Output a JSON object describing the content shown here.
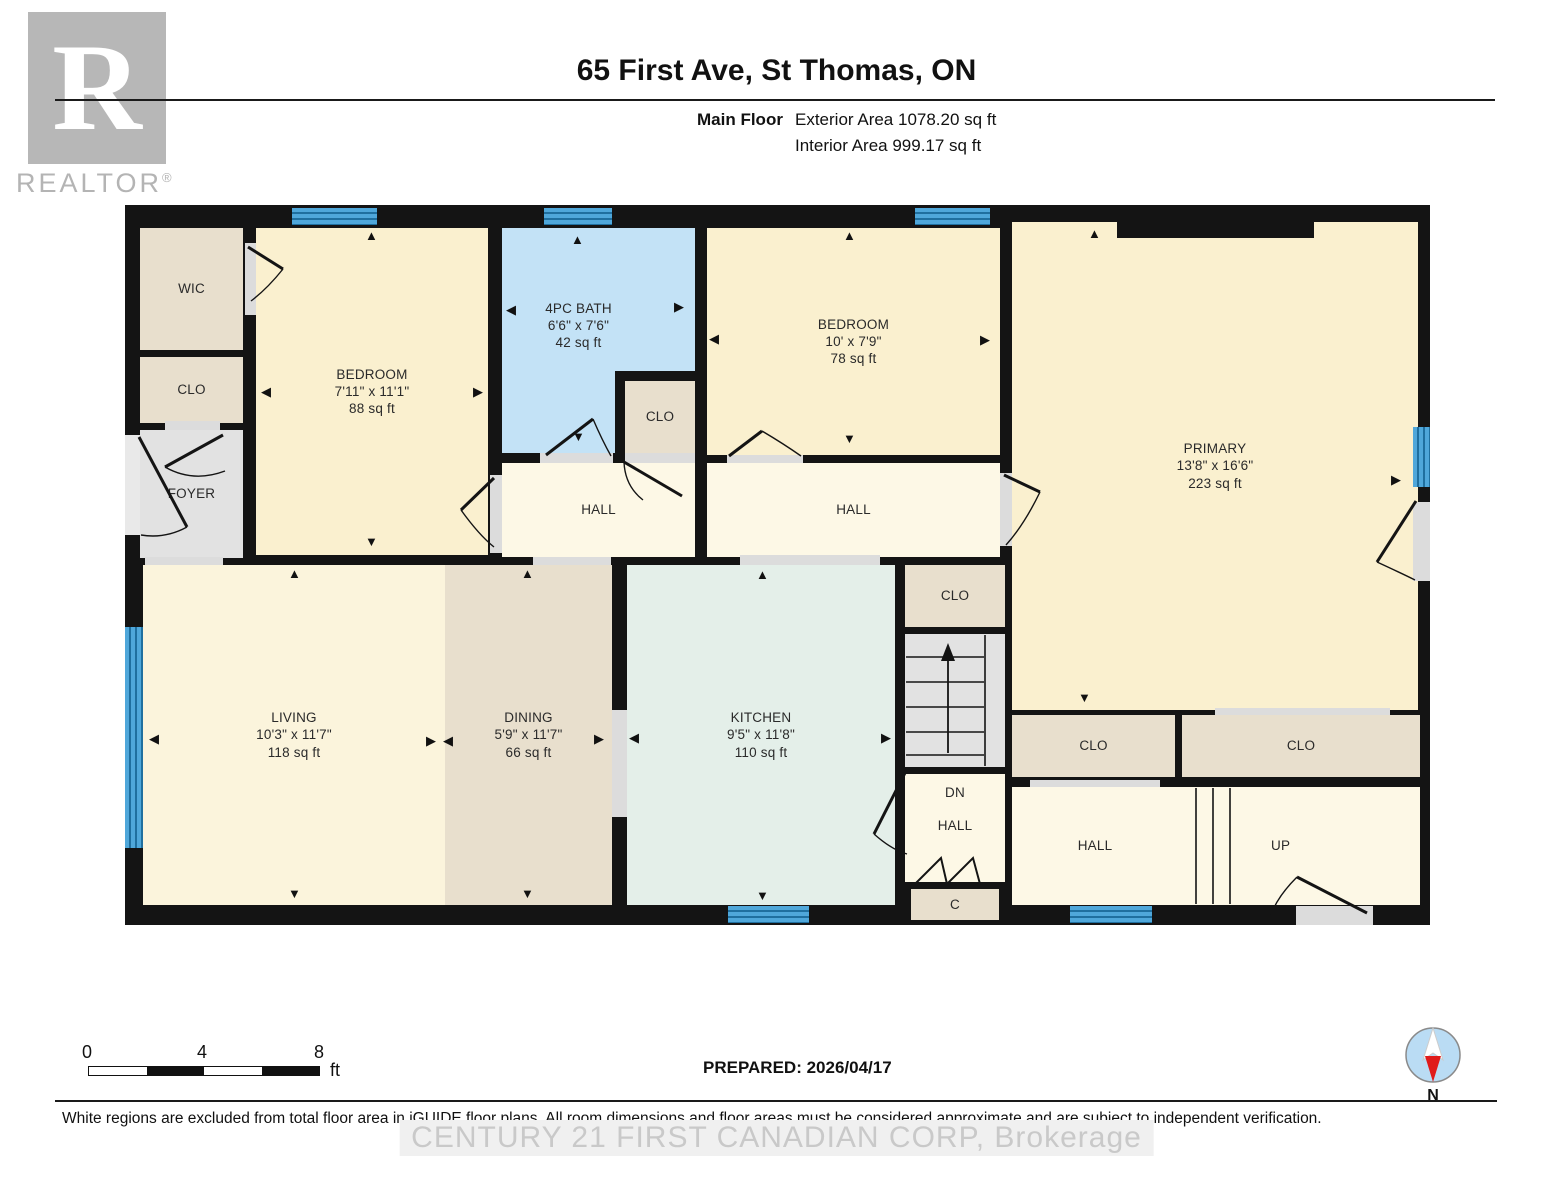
{
  "header": {
    "title": "65 First Ave, St Thomas, ON",
    "floor_label": "Main Floor",
    "exterior_area": "Exterior Area 1078.20 sq ft",
    "interior_area": "Interior Area 999.17 sq ft",
    "logo_r": "R",
    "logo_word": "REALTOR",
    "logo_reg": "®"
  },
  "rooms": {
    "wic": {
      "name": "WIC"
    },
    "clo_foyer": {
      "name": "CLO"
    },
    "foyer": {
      "name": "FOYER"
    },
    "bedroom1": {
      "name": "BEDROOM",
      "dims": "7'11\" x 11'1\"",
      "area": "88 sq ft"
    },
    "bath": {
      "name": "4PC BATH",
      "dims": "6'6\" x 7'6\"",
      "area": "42 sq ft"
    },
    "clo_bath": {
      "name": "CLO"
    },
    "bedroom2": {
      "name": "BEDROOM",
      "dims": "10' x 7'9\"",
      "area": "78 sq ft"
    },
    "primary": {
      "name": "PRIMARY",
      "dims": "13'8\" x 16'6\"",
      "area": "223 sq ft"
    },
    "hall1": {
      "name": "HALL"
    },
    "hall2": {
      "name": "HALL"
    },
    "clo_mid": {
      "name": "CLO"
    },
    "dn_hall": {
      "prefix": "DN",
      "name": "HALL"
    },
    "c_clo": {
      "name": "C"
    },
    "living": {
      "name": "LIVING",
      "dims": "10'3\" x 11'7\"",
      "area": "118 sq ft"
    },
    "dining": {
      "name": "DINING",
      "dims": "5'9\" x 11'7\"",
      "area": "66 sq ft"
    },
    "kitchen": {
      "name": "KITCHEN",
      "dims": "9'5\" x 11'8\"",
      "area": "110 sq ft"
    },
    "clo_br1": {
      "name": "CLO"
    },
    "clo_br2": {
      "name": "CLO"
    },
    "hall_br": {
      "name": "HALL"
    },
    "up": {
      "name": "UP"
    }
  },
  "icons": {
    "arrow_up": "▲",
    "arrow_down": "▼",
    "arrow_left": "◀",
    "arrow_right": "▶"
  },
  "scale": {
    "tick0": "0",
    "tick4": "4",
    "tick8": "8",
    "unit": "ft"
  },
  "footer": {
    "prepared": "PREPARED: 2026/04/17",
    "compass_label": "N",
    "disclaimer": "White regions are excluded from total floor area in iGUIDE floor plans. All room dimensions and floor areas must be considered approximate and are subject to independent verification.",
    "watermark": "CENTURY 21 FIRST CANADIAN CORP, Brokerage"
  },
  "colors": {
    "wall": "#141414",
    "room_cream": "#faf0cf",
    "hall_cream": "#fdf8e6",
    "closet_tan": "#e8dfcd",
    "foyer_gray": "#e2e2e2",
    "bath_blue": "#c3e2f6",
    "kitchen_green": "#e4efe9",
    "window_blue": "#4fa7da"
  }
}
